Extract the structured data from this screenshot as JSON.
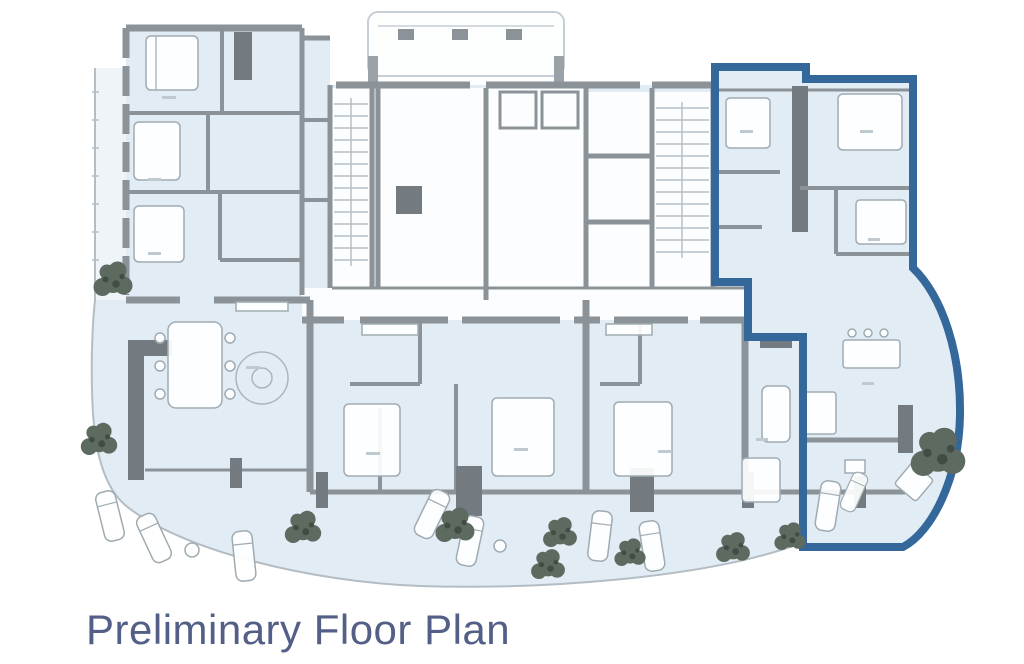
{
  "title": {
    "text": "Preliminary Floor Plan"
  },
  "plan": {
    "kind": "architectural-floor-plan",
    "highlighted_unit": {
      "position": "upper-right",
      "outline_color": "#34689A",
      "shape": "L-shaped boundary with curved terrace bulge on right side"
    },
    "colors": {
      "background": "#FFFFFF",
      "floor_fill": "#E2ECF4",
      "core_fill": "#FBFDFE",
      "wall": "#8B9298",
      "wall_dark_block": "#747B80",
      "terrace_line": "#B4BDC3",
      "tree": "#5D6A60",
      "title_text": "#535F86"
    },
    "visible_features": [
      "residential-units",
      "bedrooms-with-beds",
      "bathrooms",
      "elevator-core",
      "two-stairwells",
      "central-corridor",
      "rooftop-structure-with-vents",
      "curved-terrace-edge",
      "lounge-chairs",
      "dining-tables",
      "kitchen-island",
      "trees"
    ]
  }
}
